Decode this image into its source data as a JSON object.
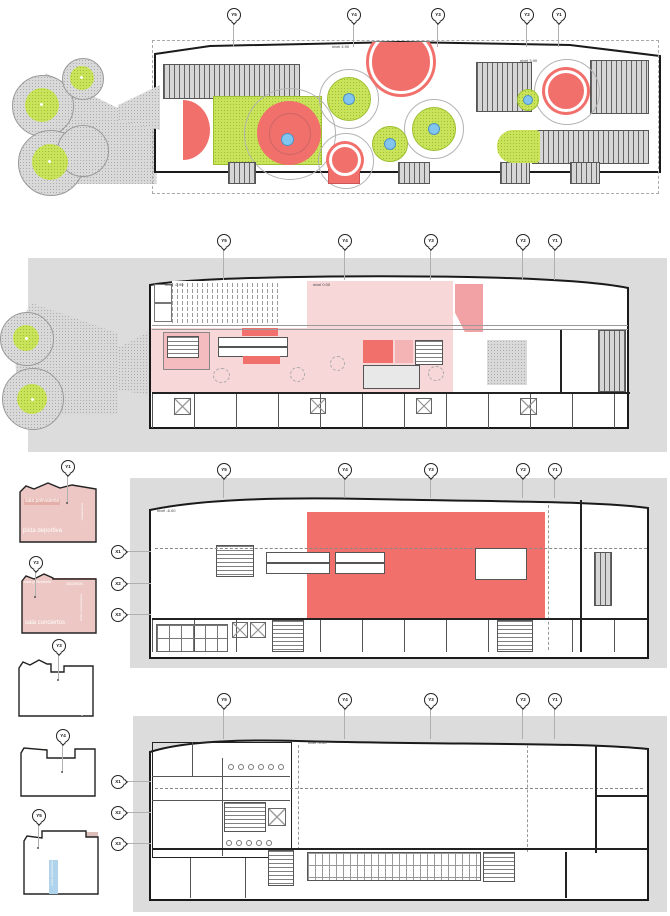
{
  "palette": {
    "red": "#f1706c",
    "light_pink": "#f8d7d8",
    "salmon": "#f29089",
    "dusty_pink": "#dcbfba",
    "thumb_pink": "#ecc7c3",
    "lime": "#c9e45a",
    "green": "#6cc24c",
    "blue": "#aed3ea",
    "gray_band": "#dcdcdc"
  },
  "grid": {
    "y_labels": [
      "Y5",
      "Y4",
      "Y3",
      "Y2",
      "Y1"
    ],
    "x_labels": [
      "X1",
      "X2",
      "X3"
    ]
  },
  "plans": {
    "roof": {
      "level_left": "nivel 4.90",
      "level_right": "nivel 3.90"
    },
    "level0": {
      "level_left": "nivel -0.90",
      "level_right": "nivel 0.00"
    },
    "m6": {
      "level": "nivel -6.00"
    },
    "m9": {
      "level": "nivel -9.00"
    }
  },
  "sections": [
    {
      "marker": "Y1",
      "labels": {
        "top": "sala polivalente",
        "side": "instalaciones",
        "main": "pista deportiva"
      }
    },
    {
      "marker": "Y2",
      "labels": {
        "top": "sala polivalente",
        "access": "accesos",
        "main": "sala conciertos",
        "core": "núcleo comunicaciones"
      }
    },
    {
      "marker": "Y3",
      "labels": {
        "top": "sala polivalente",
        "core": "núcleo comunicaciones",
        "main": "pista deportiva",
        "side": "instalaciones"
      }
    },
    {
      "marker": "Y4",
      "labels": {
        "stage": "escenario",
        "cafe": "cafetería",
        "toilets": "aseos",
        "main": "pista deportiva"
      }
    },
    {
      "marker": "Y5",
      "labels": {
        "auditorium": "auditorio",
        "mall": "calle comercial",
        "cafe": "cafetería",
        "bar": "bar",
        "services": "instalaciones",
        "toilets_a": "aseos",
        "core": "núcleo comunicaciones",
        "toilets_b": "aseos",
        "kitchen": "cocinas"
      }
    }
  ]
}
